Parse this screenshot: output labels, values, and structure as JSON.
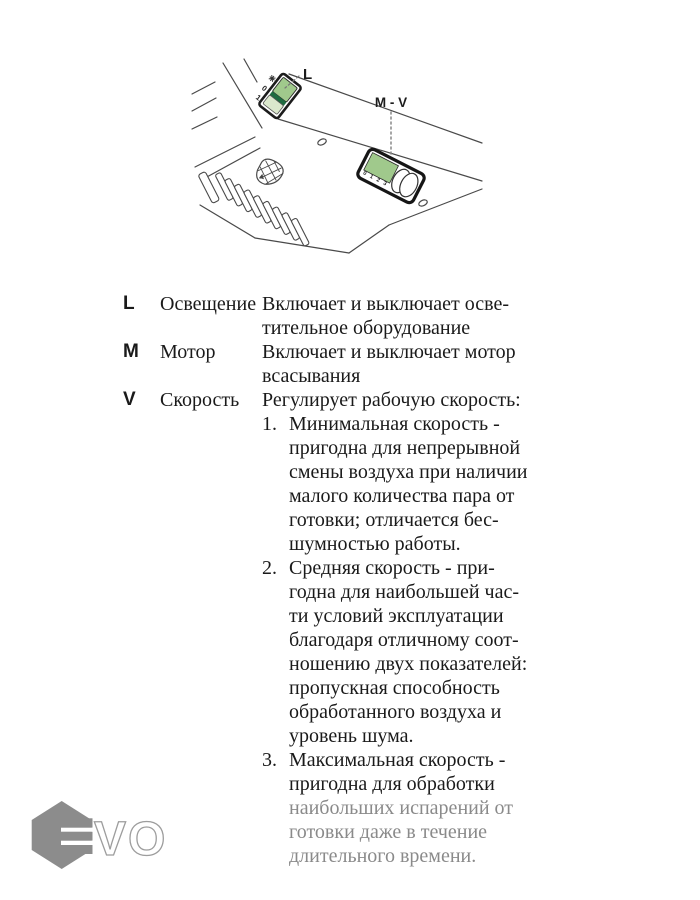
{
  "diagram": {
    "l_label": "L",
    "mv_label": "M - V",
    "rocker": {
      "zero": "0",
      "one": "1"
    },
    "slider_markings": [
      "0",
      "1",
      "2",
      "3"
    ],
    "colors": {
      "green": "#a0c98c",
      "dark_green": "#1e6b40",
      "pale_green": "#dbe8cd",
      "line": "#4a4a4a"
    }
  },
  "controls": [
    {
      "key": "L",
      "name": "Освещение",
      "description": "Включает и выключает осве-\nтительное оборудование"
    },
    {
      "key": "M",
      "name": "Мотор",
      "description": "Включает и выключает мотор\nвсасывания"
    },
    {
      "key": "V",
      "name": "Скорость",
      "description": "Регулирует рабочую скорость:"
    }
  ],
  "speed_list": [
    {
      "number": "1.",
      "text": "Минимальная скорость -\nпригодна для непрерывной\nсмены воздуха при наличии\nмалого количества пара от\nготовки; отличается бес-\nшумностью работы."
    },
    {
      "number": "2.",
      "text": "Средняя скорость - при-\nгодна для наибольшей час-\nти условий эксплуатации\nблагодаря отличному соот-\nношению двух показателей:\nпропускная способность\nобработанного воздуха и\nуровень шума."
    },
    {
      "number": "3.",
      "text_black": "Максимальная скорость -\nпригодна для обработки",
      "text_gray": "\nнаибольших испарений от\nготовки даже в течение\nдлительного времени."
    }
  ],
  "watermark": {
    "vo": "VO"
  }
}
